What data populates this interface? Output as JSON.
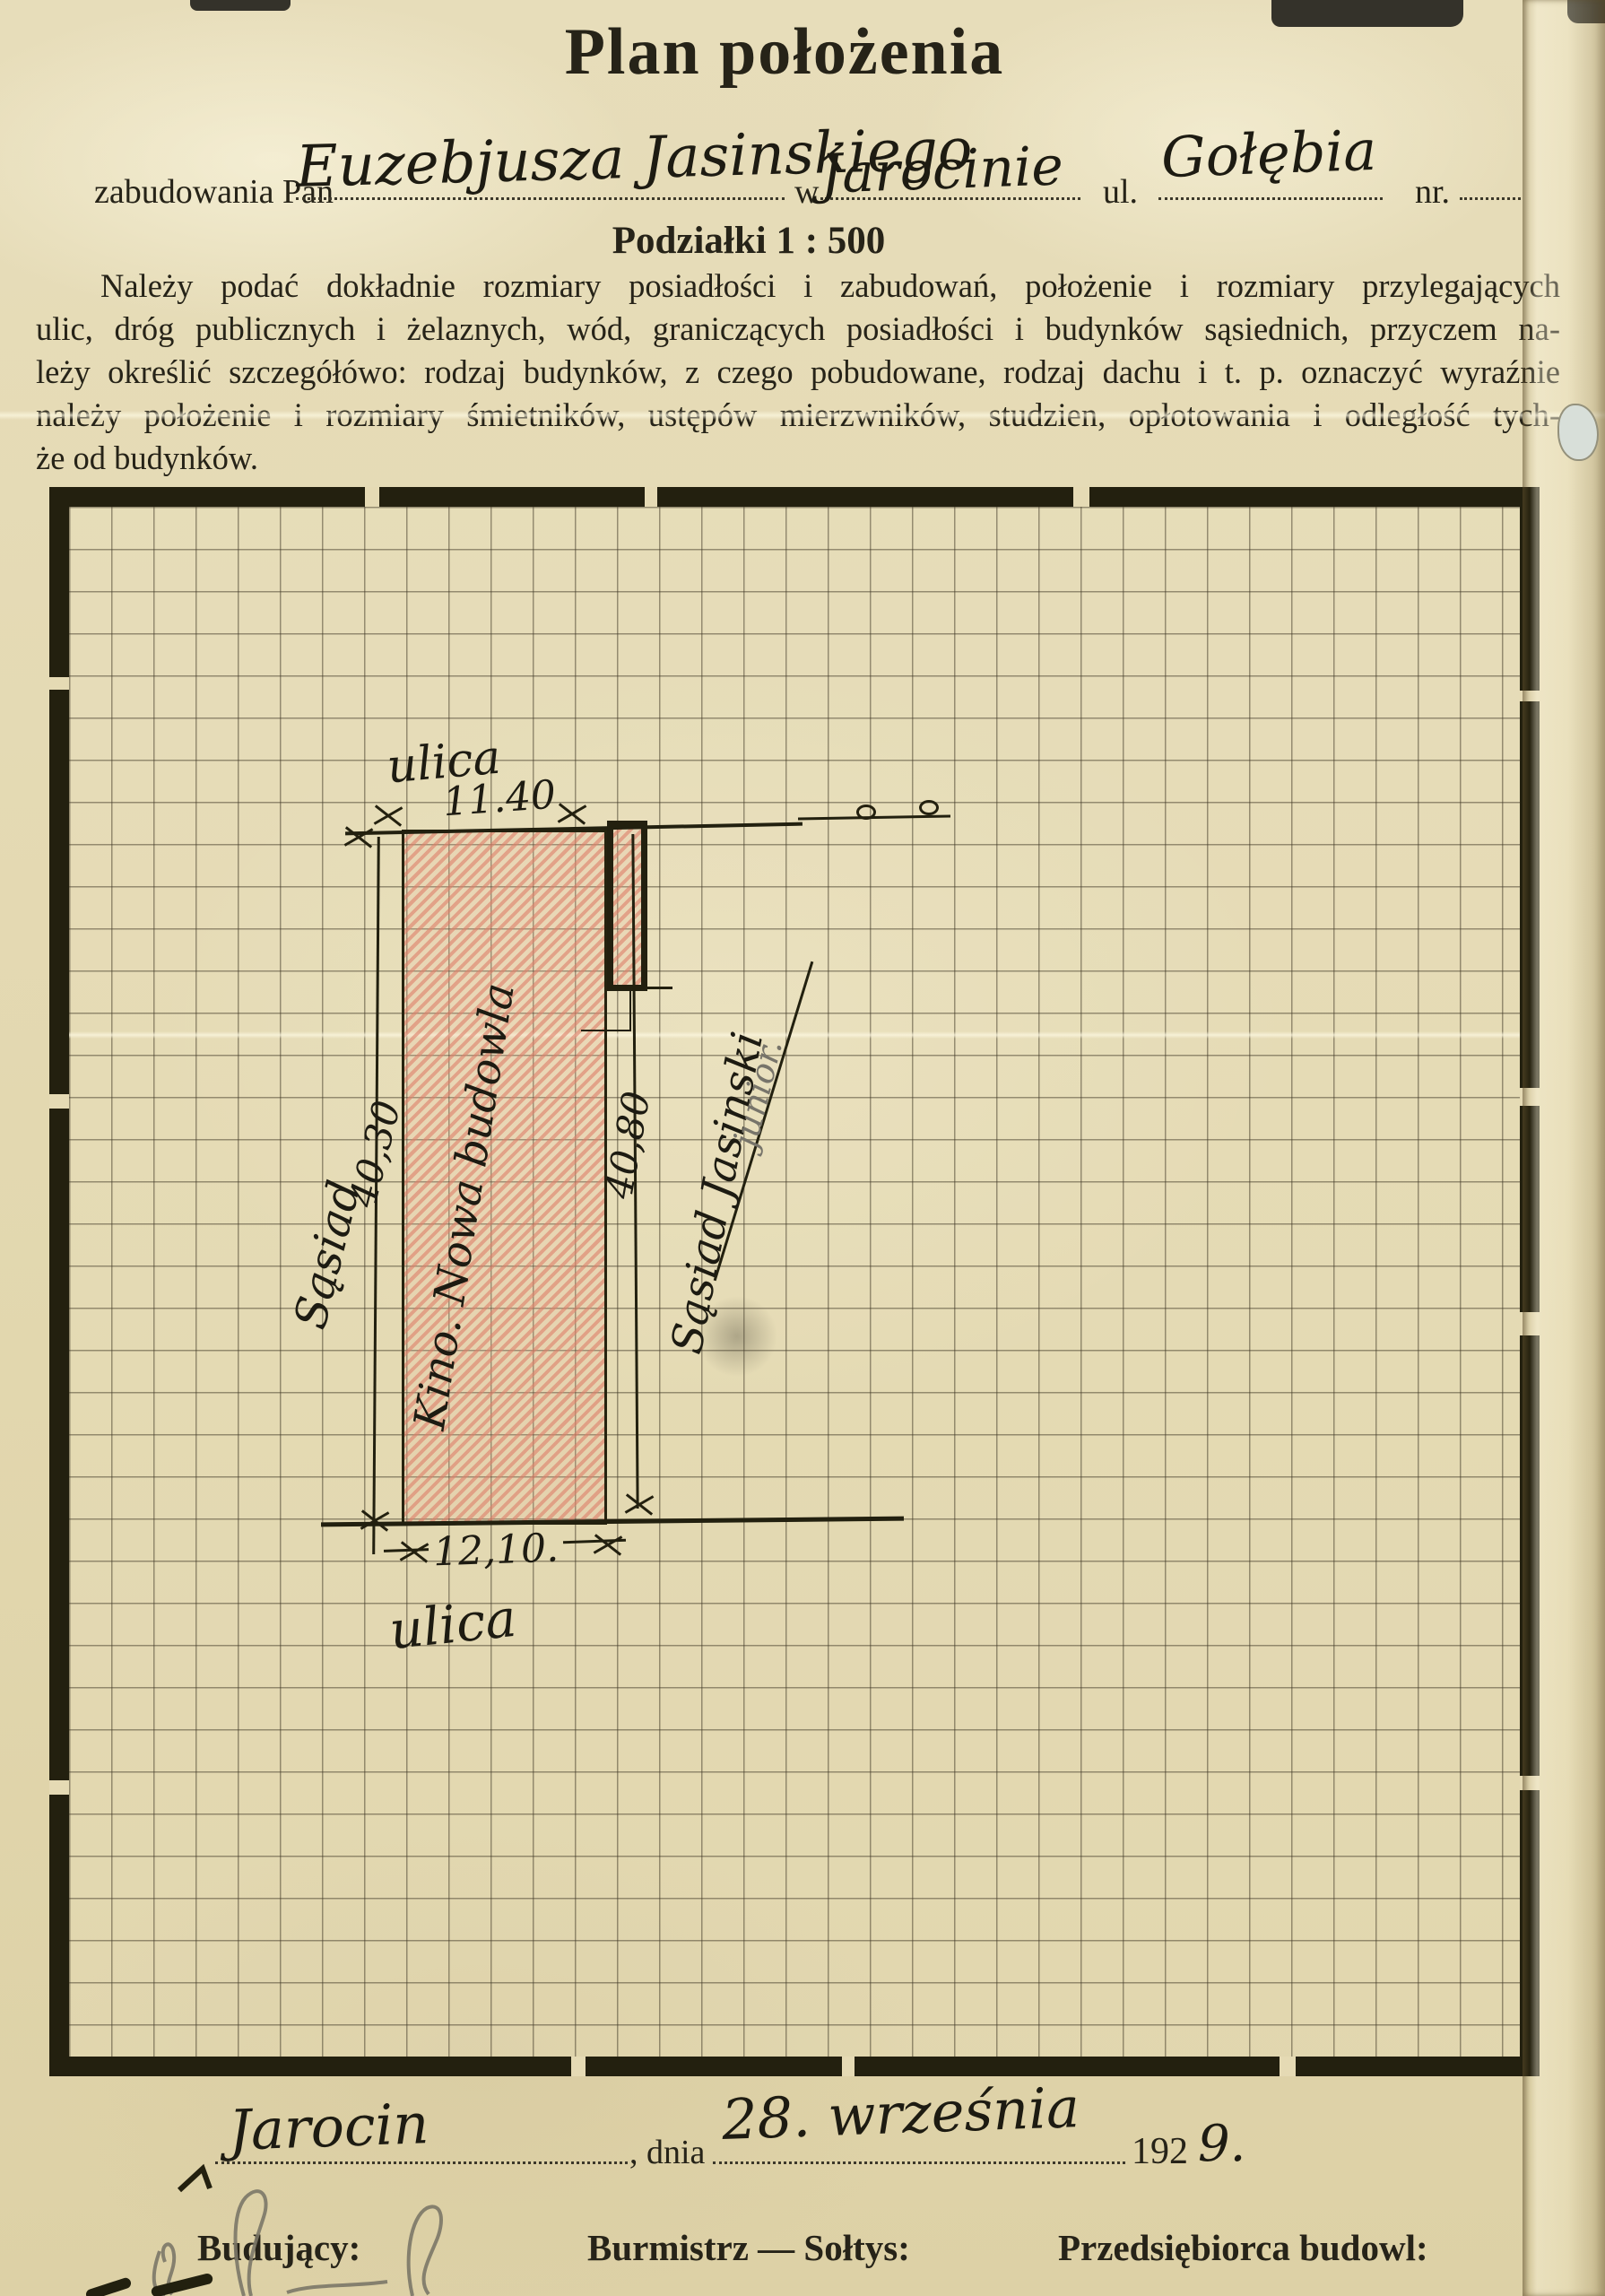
{
  "header": {
    "title": "Plan położenia",
    "form": {
      "prefix_label": "zabudowania Pan",
      "owner_name": "Euzebjusza Jasinskiego",
      "in_label": "w",
      "city": "Jarocinie",
      "street_label": "ul.",
      "street_name": "Gołębia",
      "number_label": "nr."
    },
    "scale_heading": "Podziałki 1 : 500"
  },
  "instructions": {
    "lines": [
      "Należy podać dokładnie rozmiary posiadłości i zabudowań, położenie i rozmiary przylegających",
      "ulic, dróg publicznych i żelaznych, wód, graniczących posiadłości i budynków sąsiednich, przyczem na-",
      "leży określić szczegółówo: rodzaj budynków, z czego pobudowane, rodzaj dachu i t. p. oznaczyć wyraźnie",
      "należy położenie i rozmiary śmietników, ustępów mierzwników, studzien, opłotowania i odległość tych-",
      "że od budynków."
    ]
  },
  "plan": {
    "street_top_label": "ulica",
    "dim_top": "11.40",
    "neighbor_left": "Sąsiad",
    "dim_left": "40,30",
    "building_label": "Kino. Nowa budowla",
    "dim_right": "40,80",
    "neighbor_right": "Sąsiad Jasinski",
    "neighbor_right_note": "junior.",
    "dim_bottom": "12,10.",
    "street_bottom_label": "ulica"
  },
  "footer": {
    "place": "Jarocin",
    "date_label": ", dnia",
    "date_handwritten": "28. września",
    "year_printed": "192",
    "year_handwritten": "9.",
    "builder_label": "Budujący:",
    "mayor_label": "Burmistrz — Sołtys:",
    "contractor_label": "Przedsiębiorca budowl:"
  },
  "colors": {
    "paper": "#e4dab4",
    "ink": "#23200f",
    "hatch_red": "#db7862",
    "pencil": "#77746a"
  }
}
